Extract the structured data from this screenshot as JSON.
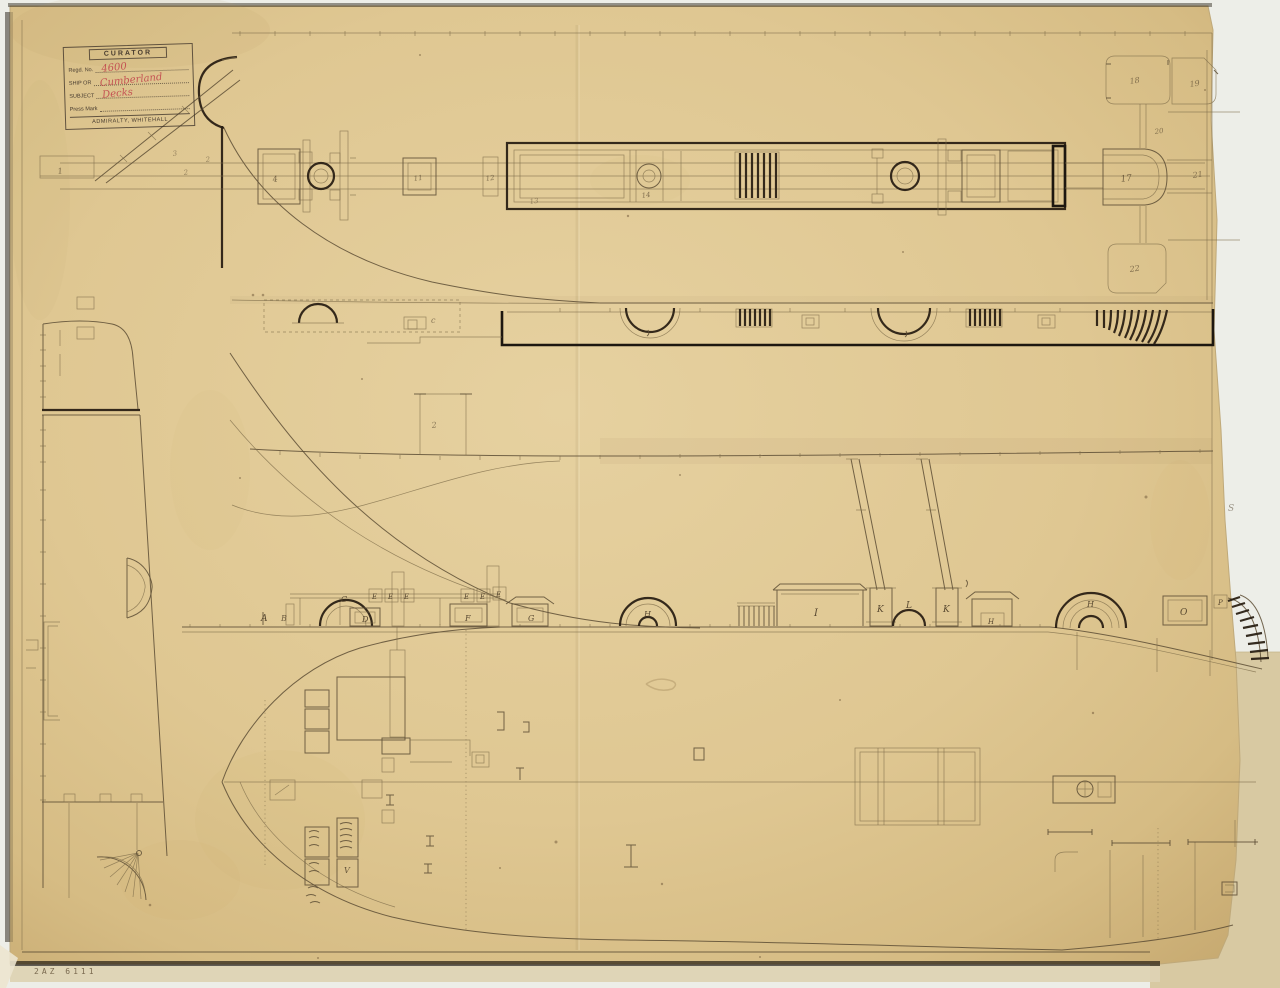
{
  "colors": {
    "paper": "#dfc792",
    "paper_edge": "#c8ab72",
    "backing_sheet": "#d8c9a2",
    "ink_faint": "#7d6c4a",
    "ink_medium": "#5d4e35",
    "ink_dark": "#2a2014",
    "stamp_ink": "#3a3028",
    "stamp_script_red": "#c2474d"
  },
  "stamp": {
    "title": "CURATOR",
    "fields": [
      {
        "label": "Regd. No.",
        "value": "4600"
      },
      {
        "label": "SHIP OR",
        "value": "Cumberland"
      },
      {
        "label": "SUBJECT",
        "value": "Decks"
      },
      {
        "label": "Press Mark",
        "value": ""
      }
    ],
    "footer": "ADMIRALTY, WHITEHALL"
  },
  "archive_mark": "2AZ 6111",
  "drawing_labels": [
    {
      "t": "A",
      "x": 261,
      "y": 621,
      "s": 9
    },
    {
      "t": "B",
      "x": 281,
      "y": 621,
      "s": 8,
      "o": 0.75
    },
    {
      "t": "C",
      "x": 341,
      "y": 602,
      "s": 8
    },
    {
      "t": "D",
      "x": 362,
      "y": 622,
      "s": 8
    },
    {
      "t": "E",
      "x": 372,
      "y": 599,
      "s": 7
    },
    {
      "t": "E",
      "x": 388,
      "y": 599,
      "s": 7
    },
    {
      "t": "E",
      "x": 404,
      "y": 599,
      "s": 7
    },
    {
      "t": "E",
      "x": 464,
      "y": 599,
      "s": 7
    },
    {
      "t": "E",
      "x": 480,
      "y": 599,
      "s": 7
    },
    {
      "t": "E",
      "x": 496,
      "y": 597,
      "s": 7
    },
    {
      "t": "F",
      "x": 465,
      "y": 621,
      "s": 8
    },
    {
      "t": "G",
      "x": 528,
      "y": 621,
      "s": 8
    },
    {
      "t": "H",
      "x": 644,
      "y": 617,
      "s": 8
    },
    {
      "t": "I",
      "x": 814,
      "y": 616,
      "s": 10
    },
    {
      "t": "K",
      "x": 877,
      "y": 612,
      "s": 9
    },
    {
      "t": "L",
      "x": 906,
      "y": 608,
      "s": 9
    },
    {
      "t": "K",
      "x": 943,
      "y": 612,
      "s": 9
    },
    {
      "t": "H",
      "x": 988,
      "y": 624,
      "s": 7
    },
    {
      "t": "H",
      "x": 1087,
      "y": 607,
      "s": 8
    },
    {
      "t": "O",
      "x": 1180,
      "y": 615,
      "s": 9
    },
    {
      "t": "P",
      "x": 1218,
      "y": 605,
      "s": 7
    },
    {
      "t": "c",
      "x": 431,
      "y": 323,
      "s": 8,
      "o": 0.6
    },
    {
      "t": "V",
      "x": 344,
      "y": 873,
      "s": 8,
      "o": 0.8
    },
    {
      "t": "S",
      "x": 1228,
      "y": 511,
      "s": 9,
      "o": 0.5
    },
    {
      "t": "1",
      "x": 58,
      "y": 174,
      "s": 8,
      "o": 0.7,
      "r": -8
    },
    {
      "t": "3",
      "x": 173,
      "y": 156,
      "s": 7,
      "o": 0.5,
      "r": -8
    },
    {
      "t": "2",
      "x": 184,
      "y": 175,
      "s": 7,
      "o": 0.5,
      "r": -8
    },
    {
      "t": "2",
      "x": 206,
      "y": 162,
      "s": 7,
      "o": 0.5,
      "r": -8
    },
    {
      "t": "4",
      "x": 273,
      "y": 182,
      "s": 8,
      "o": 0.7,
      "r": -8
    },
    {
      "t": "11",
      "x": 414,
      "y": 181,
      "s": 7,
      "o": 0.65,
      "r": -8
    },
    {
      "t": "12",
      "x": 486,
      "y": 181,
      "s": 7,
      "o": 0.65,
      "r": -8
    },
    {
      "t": "13",
      "x": 530,
      "y": 204,
      "s": 7,
      "o": 0.5,
      "r": -8
    },
    {
      "t": "14",
      "x": 642,
      "y": 198,
      "s": 7,
      "o": 0.65,
      "r": -8
    },
    {
      "t": "2",
      "x": 432,
      "y": 428,
      "s": 8,
      "o": 0.6,
      "r": -8
    },
    {
      "t": "17",
      "x": 1121,
      "y": 182,
      "s": 9,
      "o": 0.7,
      "r": -8
    },
    {
      "t": "18",
      "x": 1130,
      "y": 84,
      "s": 8,
      "o": 0.6,
      "r": -8
    },
    {
      "t": "19",
      "x": 1190,
      "y": 87,
      "s": 8,
      "o": 0.6,
      "r": -8
    },
    {
      "t": "20",
      "x": 1155,
      "y": 134,
      "s": 7,
      "o": 0.6,
      "r": -8
    },
    {
      "t": "21",
      "x": 1193,
      "y": 178,
      "s": 8,
      "o": 0.6,
      "r": -8
    },
    {
      "t": "22",
      "x": 1130,
      "y": 272,
      "s": 8,
      "o": 0.65,
      "r": -8
    }
  ]
}
